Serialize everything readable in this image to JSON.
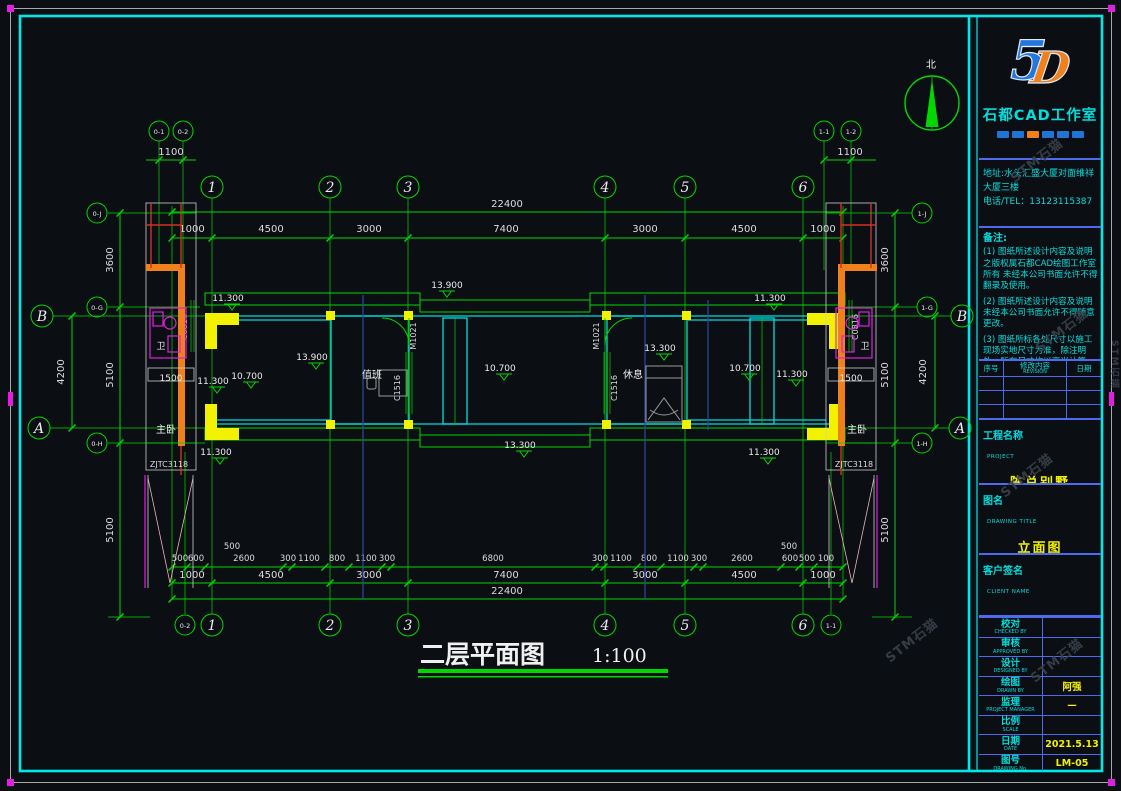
{
  "colors": {
    "bg": "#0b0e13",
    "green": "#00d800",
    "cyan": "#00dede",
    "yellow": "#f2f200",
    "orange": "#f08019",
    "magenta": "#e020e0",
    "red": "#d43020",
    "white": "#ececec",
    "blue_rule": "#4f6bed",
    "logo_blue": "#2277dd",
    "logo_orange": "#f08019",
    "value_yellow": "#f2f200"
  },
  "watermark": "STM石猫",
  "north_label": "北",
  "plan_title": {
    "text": "二层平面图",
    "scale": "1:100"
  },
  "axis": {
    "n1": "1",
    "n2": "2",
    "n3": "3",
    "n4": "4",
    "n5": "5",
    "n6": "6",
    "A": "A",
    "B": "B",
    "tl1": "0-1",
    "tl2": "0-2",
    "tr1": "1-1",
    "tr2": "1-2",
    "l_top": "0-J",
    "l_mid": "0-G",
    "l_bot": "0-H",
    "r_top": "1-J",
    "r_mid": "1-G",
    "r_bot": "1-H",
    "bl": "0-2",
    "br": "1-1",
    "offset": "1100"
  },
  "dims": {
    "total": "22400",
    "chain": [
      "1000",
      "4500",
      "3000",
      "7400",
      "3000",
      "4500",
      "1000"
    ],
    "detail": [
      "500",
      "600",
      "2600",
      "300",
      "1100",
      "800",
      "1100",
      "300",
      "6800",
      "300",
      "1100",
      "800",
      "1100",
      "300",
      "2600",
      "600",
      "500",
      "100"
    ],
    "raised": "500",
    "side": [
      "3600",
      "5100",
      "5100"
    ],
    "inner": "4200",
    "wing": "1500"
  },
  "levels": [
    "13.900",
    "13.900",
    "10.700",
    "10.700",
    "13.300",
    "13.300",
    "11.300",
    "11.300",
    "11.300",
    "11.300",
    "11.300",
    "11.300",
    "10.700"
  ],
  "rooms": {
    "duty": "值班",
    "rest": "休息",
    "master": "主卧",
    "wc": "卫"
  },
  "tags": {
    "door": "M1021",
    "win": "C1516",
    "win2": "C0816",
    "code": "ZJTC3118"
  },
  "title_block": {
    "logo5": "5",
    "logoD": "D",
    "studio": "石都CAD工作室",
    "address1": "地址:水头汇盛大厦对面维祥",
    "address2": "大厦三楼",
    "phone": "电话/TEL：13123115387",
    "notes_title": "备注:",
    "notes": [
      "(1) 图纸所述设计内容及说明之版权属石都CAD绘图工作室所有 未经本公司书面允许不得翻录及使用。",
      "(2) 图纸所述设计内容及说明未经本公司书面允许不得随意更改。",
      "(3) 图纸所标各处尺寸以施工现场实地尺寸为准，除注明外，所有尺寸均以毫米计算。"
    ],
    "rev": {
      "no": "序号",
      "content": "修改内容",
      "content_en": "REVISION",
      "date": "日期"
    },
    "project_label": "工程名称",
    "project_label_en": "PROJECT",
    "project": "陈总别墅",
    "drawing_label": "图名",
    "drawing_label_en": "DRAWING TITLE",
    "drawing": "立面图",
    "client_label": "客户签名",
    "client_label_en": "CLIENT NAME",
    "rows": [
      {
        "cn": "校对",
        "en": "CHECKED BY",
        "val": ""
      },
      {
        "cn": "审核",
        "en": "APPROVED BY",
        "val": ""
      },
      {
        "cn": "设计",
        "en": "DESIGNED BY",
        "val": ""
      },
      {
        "cn": "绘图",
        "en": "DRAWN BY",
        "val": "阿强"
      },
      {
        "cn": "监理",
        "en": "PROJECT MANAGER",
        "val": "—"
      },
      {
        "cn": "比例",
        "en": "SCALE",
        "val": ""
      },
      {
        "cn": "日期",
        "en": "DATE",
        "val": "2021.5.13"
      },
      {
        "cn": "图号",
        "en": "DRAWING No.",
        "val": "LM-05"
      }
    ]
  }
}
